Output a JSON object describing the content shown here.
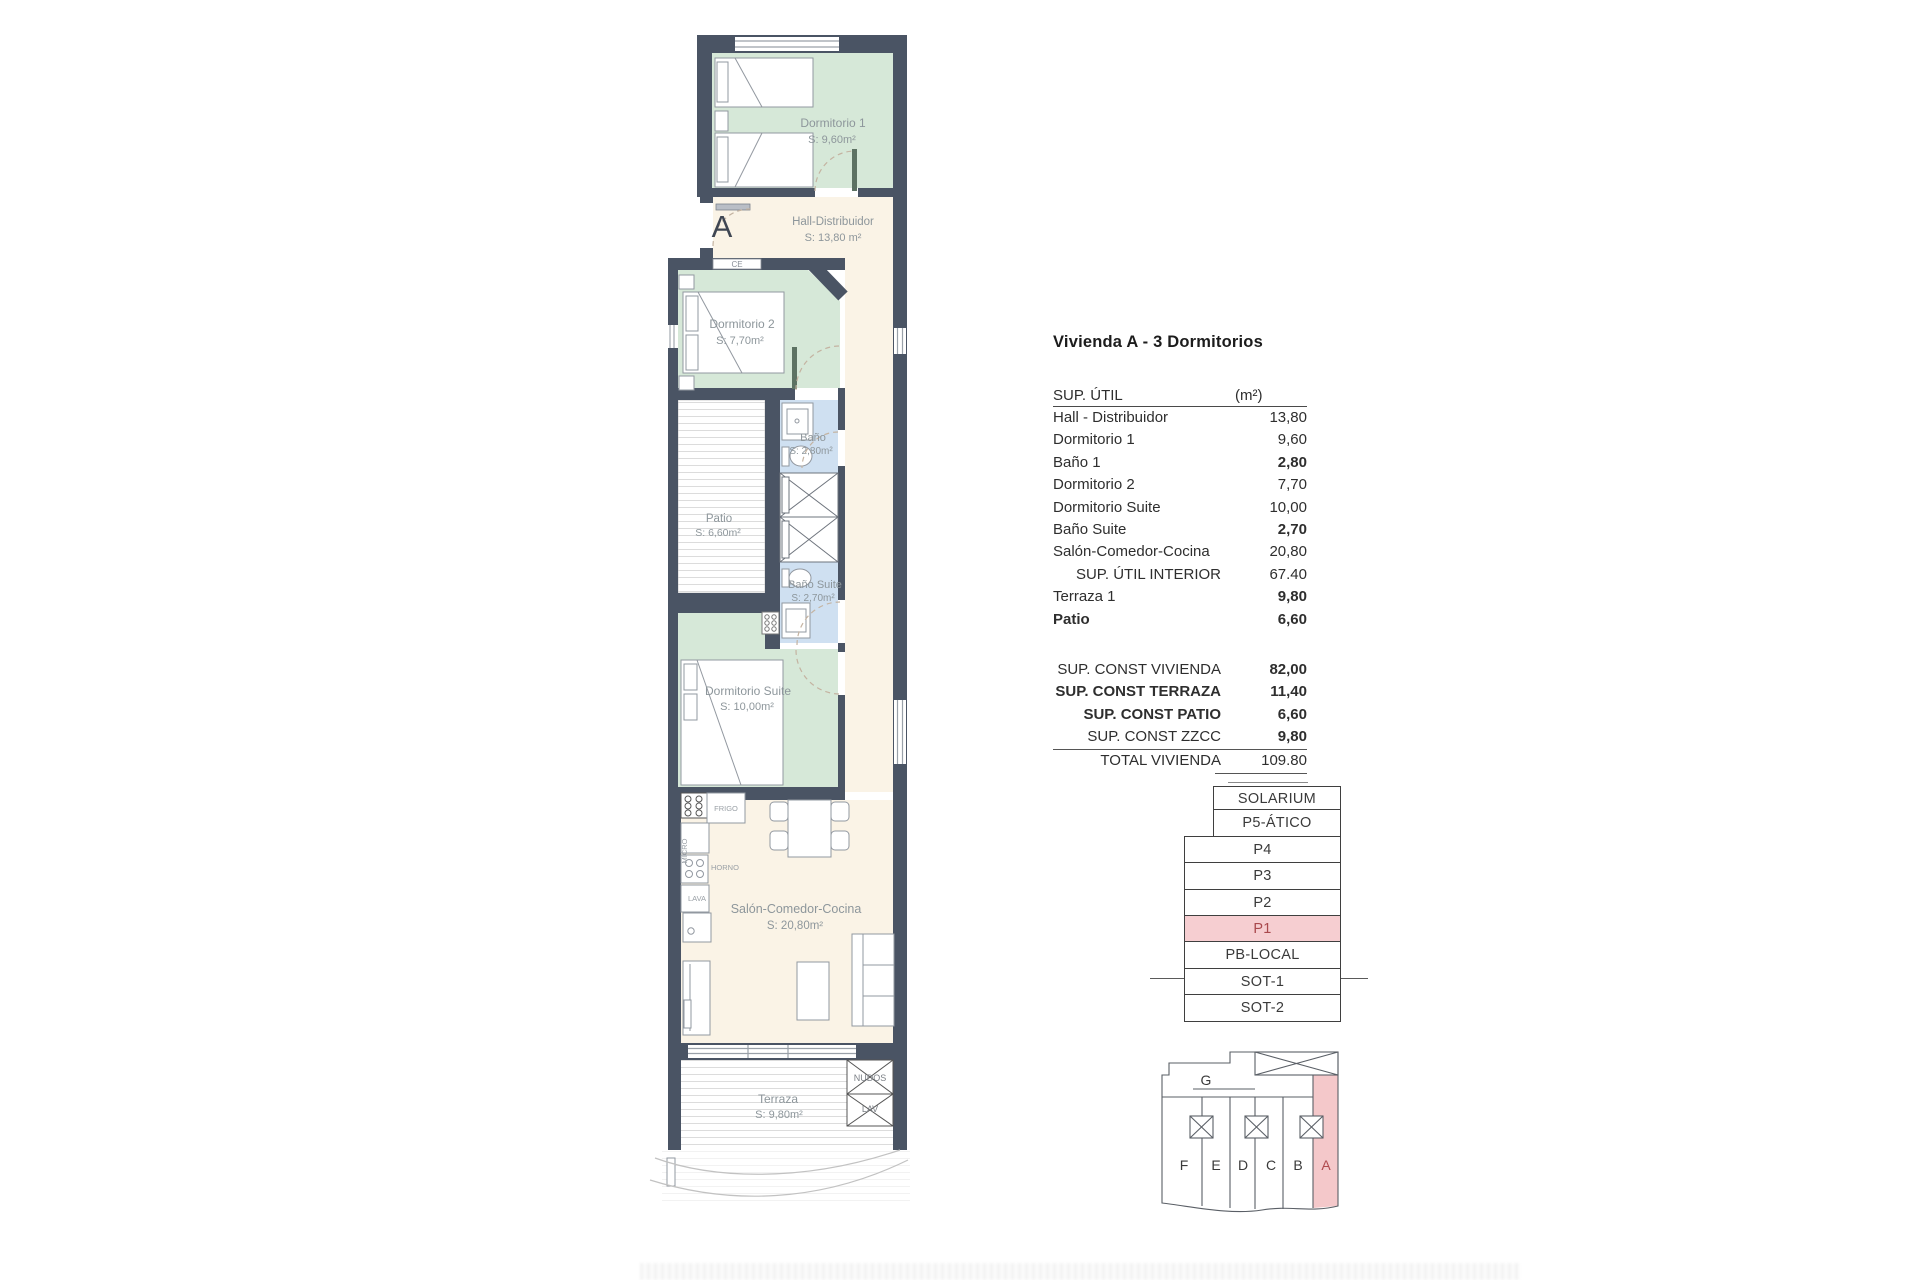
{
  "colors": {
    "wall": "#4a5464",
    "room_green": "#d6e8d8",
    "room_cream": "#faf3e6",
    "room_blue": "#cfe0f1",
    "highlight_pink": "#f6ced1",
    "highlight_text": "#a9494d",
    "label_gray": "#8d969b"
  },
  "plan": {
    "entrance_label": "A",
    "ce_label": "CE",
    "rooms": {
      "dormitorio1": {
        "name": "Dormitorio 1",
        "area": "S: 9,60m²"
      },
      "hall": {
        "name": "Hall-Distribuidor",
        "area": "S: 13,80 m²"
      },
      "dormitorio2": {
        "name": "Dormitorio 2",
        "area": "S: 7,70m²"
      },
      "bano1": {
        "name": "Baño",
        "area": "S: 2,80m²"
      },
      "patio": {
        "name": "Patio",
        "area": "S: 6,60m²"
      },
      "bano_suite": {
        "name": "Baño Suite",
        "area": "S: 2,70m²"
      },
      "dormitorio_suite": {
        "name": "Dormitorio Suite",
        "area": "S: 10,00m²"
      },
      "salon": {
        "name": "Salón-Comedor-Cocina",
        "area": "S: 20,80m²"
      },
      "terraza": {
        "name": "Terraza",
        "area": "S: 9,80m²"
      }
    },
    "kitchen": {
      "frigo": "FRIGO",
      "micro": "MICRO",
      "horno": "HORNO",
      "lava": "LAVA"
    },
    "terrace_closets": {
      "top": "NUDOS",
      "bottom": "LAV"
    }
  },
  "summary": {
    "title": "Vivienda A - 3 Dormitorios",
    "util_table": {
      "header": {
        "label": "SUP. ÚTIL",
        "unit": "(m²)"
      },
      "rows": [
        {
          "label": "Hall - Distribuidor",
          "value": "13,80"
        },
        {
          "label": "Dormitorio 1",
          "value": "9,60"
        },
        {
          "label": "Baño 1",
          "value": "2,80"
        },
        {
          "label": "Dormitorio 2",
          "value": "7,70"
        },
        {
          "label": "Dormitorio Suite",
          "value": "10,00"
        },
        {
          "label": "Baño Suite",
          "value": "2,70"
        },
        {
          "label": "Salón-Comedor-Cocina",
          "value": "20,80"
        },
        {
          "label": "SUP. ÚTIL INTERIOR",
          "value": "67.40"
        },
        {
          "label": "Terraza 1",
          "value": "9,80"
        },
        {
          "label": "Patio",
          "value": "6,60"
        }
      ]
    },
    "const_table": {
      "rows": [
        {
          "label": "SUP. CONST VIVIENDA",
          "value": "82,00"
        },
        {
          "label": "SUP. CONST TERRAZA",
          "value": "11,40"
        },
        {
          "label": "SUP. CONST PATIO",
          "value": "6,60"
        },
        {
          "label": "SUP. CONST ZZCC",
          "value": "9,80"
        }
      ],
      "total": {
        "label": "TOTAL VIVIENDA",
        "value": "109.80"
      }
    }
  },
  "floor_stack": {
    "levels": [
      {
        "label": "SOLARIUM"
      },
      {
        "label": "P5-ÁTICO"
      },
      {
        "label": "P4"
      },
      {
        "label": "P3"
      },
      {
        "label": "P2"
      },
      {
        "label": "P1",
        "highlight": true
      },
      {
        "label": "PB-LOCAL"
      },
      {
        "label": "SOT-1"
      },
      {
        "label": "SOT-2"
      }
    ]
  },
  "key_plan": {
    "top_unit": "G",
    "units": [
      "F",
      "E",
      "D",
      "C",
      "B",
      "A"
    ],
    "highlighted_unit": "A"
  }
}
